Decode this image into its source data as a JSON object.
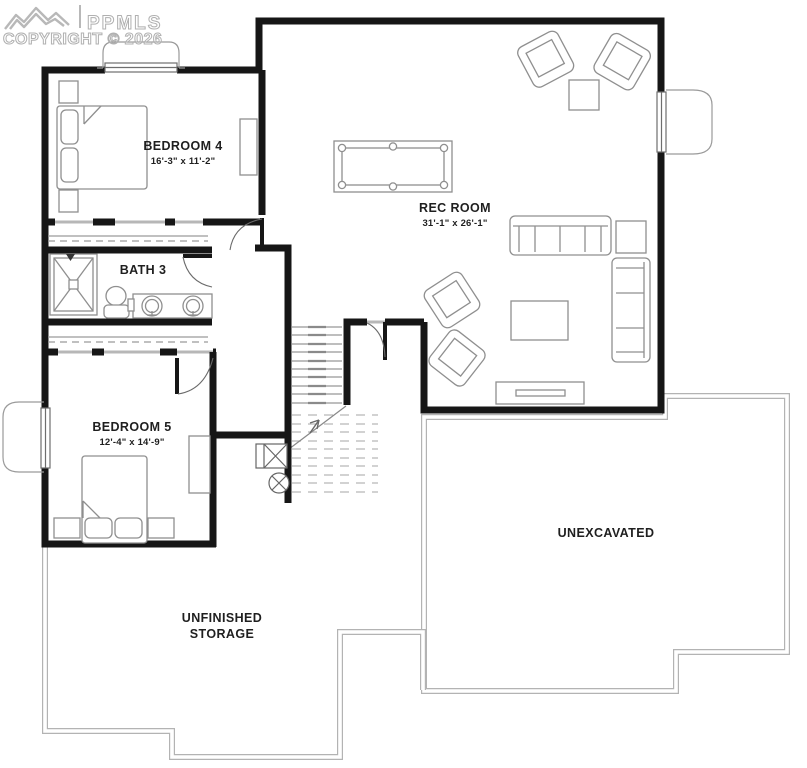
{
  "watermark": {
    "logo": "mountains-logo",
    "brand": "PPMLS",
    "copyright": "COPYRIGHT © 2026"
  },
  "rooms": {
    "bedroom4": {
      "name": "BEDROOM 4",
      "dims": "16'-3\" x 11'-2\""
    },
    "rec_room": {
      "name": "REC ROOM",
      "dims": "31'-1\" x 26'-1\""
    },
    "bath3": {
      "name": "BATH 3"
    },
    "bedroom5": {
      "name": "BEDROOM 5",
      "dims": "12'-4\" x 14'-9\""
    },
    "unexcavated": {
      "name": "UNEXCAVATED"
    },
    "storage": {
      "line1": "UNFINISHED",
      "line2": "STORAGE"
    }
  },
  "colors": {
    "wall": "#161616",
    "furniture_line": "#8f8f8f",
    "foundation_line": "#b3b3b3",
    "label_text": "#1f1f1f",
    "watermark": "#b0b0b0"
  }
}
